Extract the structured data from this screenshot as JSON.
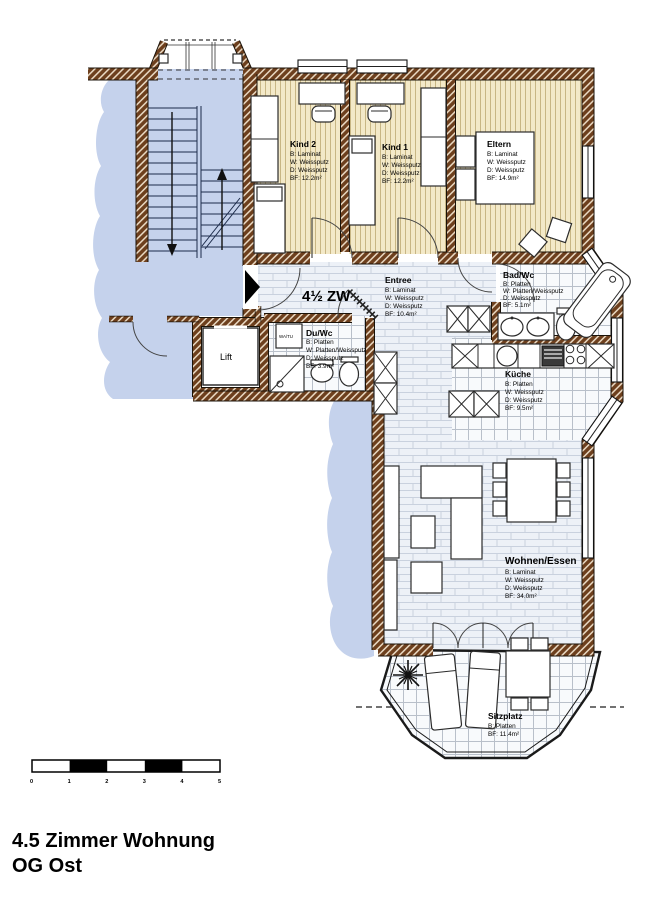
{
  "title": {
    "line1": "4.5 Zimmer Wohnung",
    "line2": "OG Ost"
  },
  "plan": {
    "apartment_type": "4½ ZW",
    "lift_label": "Lift",
    "watu_label": "WA/TU"
  },
  "rooms": {
    "kind2": {
      "name": "Kind 2",
      "floor": "B: Laminat",
      "walls": "W: Weissputz",
      "ceiling": "D: Weissputz",
      "area": "BF: 12.2m²"
    },
    "kind1": {
      "name": "Kind 1",
      "floor": "B: Laminat",
      "walls": "W: Weissputz",
      "ceiling": "D: Weissputz",
      "area": "BF: 12.2m²"
    },
    "eltern": {
      "name": "Eltern",
      "floor": "B: Laminat",
      "walls": "W: Weissputz",
      "ceiling": "D: Weissputz",
      "area": "BF: 14.9m²"
    },
    "entree": {
      "name": "Entree",
      "floor": "B: Laminat",
      "walls": "W: Weissputz",
      "ceiling": "D: Weissputz",
      "area": "BF: 10.4m²"
    },
    "badwc": {
      "name": "Bad/Wc",
      "floor": "B: Platten",
      "walls": "W: Platten/Weissputz",
      "ceiling": "D: Weissputz",
      "area": "BF: 5.1m²"
    },
    "kueche": {
      "name": "Küche",
      "floor": "B: Platten",
      "walls": "W: Weissputz",
      "ceiling": "D: Weissputz",
      "area": "BF: 9.5m²"
    },
    "duwc": {
      "name": "Du/Wc",
      "floor": "B: Platten",
      "walls": "W: Platten/Weissputz",
      "ceiling": "D: Weissputz",
      "area": "BF: 3.9m²"
    },
    "wohnen": {
      "name": "Wohnen/Essen",
      "floor": "B: Laminat",
      "walls": "W: Weissputz",
      "ceiling": "D: Weissputz",
      "area": "BF: 34.0m²"
    },
    "sitzplatz": {
      "name": "Sitzplatz",
      "floor": "B: Platten",
      "area": "BF: 11.4m²"
    }
  },
  "scale_bar": {
    "ticks": [
      "0",
      "1",
      "2",
      "3",
      "4",
      "5"
    ]
  },
  "colors": {
    "common_area": "#c5d2ec",
    "wall": "#6d3f1d",
    "wood_floor": "#f3e9c8",
    "laminate_floor": "#edf1f7",
    "tile_floor": "#f8fafc"
  }
}
